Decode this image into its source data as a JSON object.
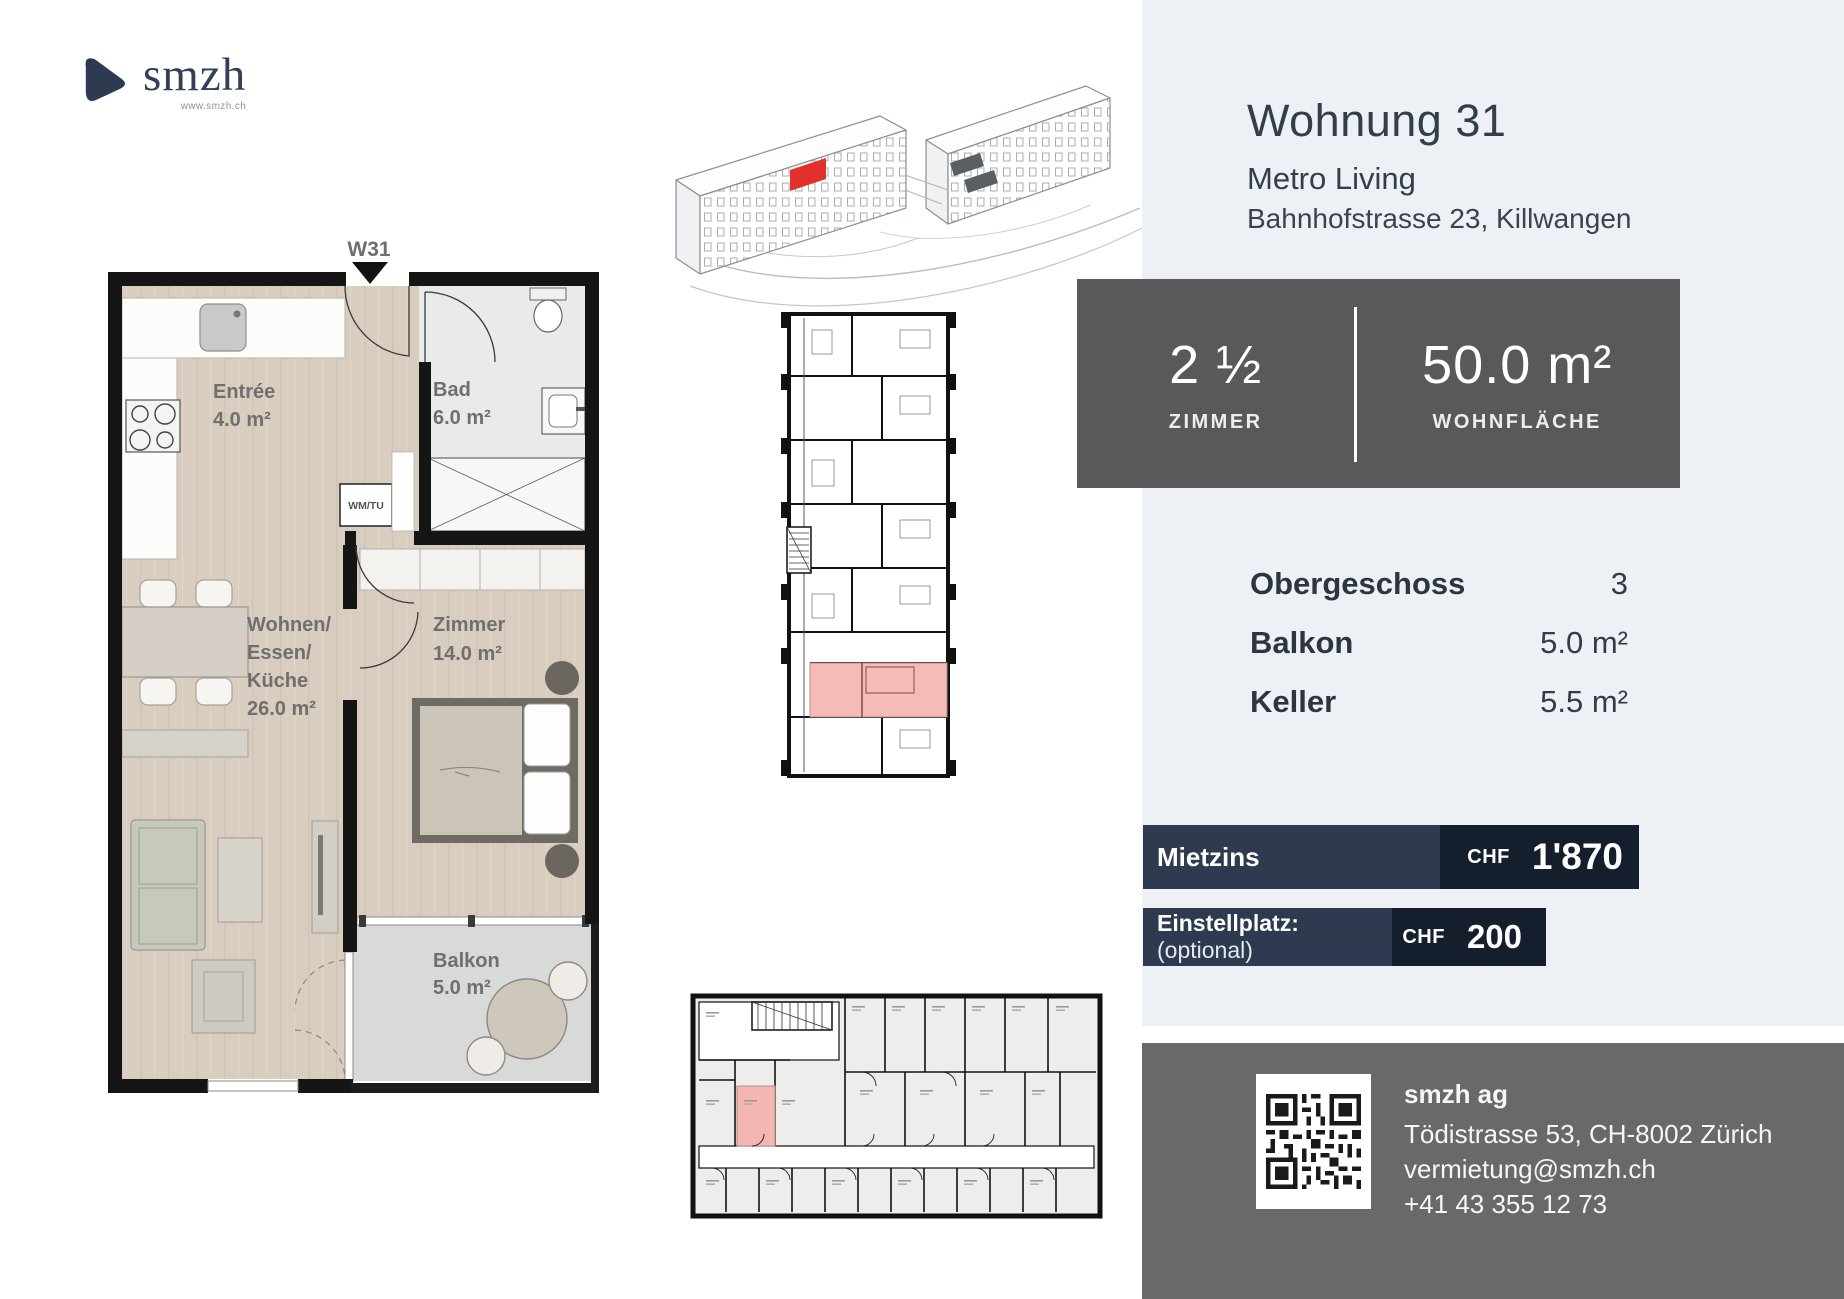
{
  "brand": {
    "name": "smzh",
    "website": "www.smzh.ch"
  },
  "header": {
    "title": "Wohnung 31",
    "project": "Metro Living",
    "address": "Bahnhofstrasse 23, Killwangen"
  },
  "stats": {
    "rooms": {
      "value": "2 ½",
      "label": "ZIMMER"
    },
    "area": {
      "value": "50.0 m²",
      "label": "WOHNFLÄCHE"
    }
  },
  "details": {
    "rows": [
      {
        "label": "Obergeschoss",
        "value": "3"
      },
      {
        "label": "Balkon",
        "value": "5.0 m²"
      },
      {
        "label": "Keller",
        "value": "5.5 m²"
      }
    ]
  },
  "pricing": {
    "rent": {
      "label": "Mietzins",
      "currency": "CHF",
      "value": "1'870"
    },
    "parking": {
      "label": "Einstellplatz:",
      "suffix": "(optional)",
      "currency": "CHF",
      "value": "200"
    }
  },
  "contact": {
    "company": "smzh ag",
    "address": "Tödistrasse 53, CH-8002 Zürich",
    "email": "vermietung@smzh.ch",
    "phone": "+41 43 355 12 73"
  },
  "floorplan": {
    "unit": "W31",
    "entree": {
      "name": "Entrée",
      "area": "4.0 m²"
    },
    "bad": {
      "name": "Bad",
      "area": "6.0 m²"
    },
    "wm": "WM/TU",
    "living": {
      "line1": "Wohnen/",
      "line2": "Essen/",
      "line3": "Küche",
      "area": "26.0 m²"
    },
    "zimmer": {
      "name": "Zimmer",
      "area": "14.0 m²"
    },
    "balkon": {
      "name": "Balkon",
      "area": "5.0 m²"
    }
  },
  "colors": {
    "panel": "#edf1f6",
    "stats_box": "#59595b",
    "footer": "#69696b",
    "navy": "#2d3a50",
    "navy_dark": "#141e2c",
    "unit_highlight_red": "#e0312a",
    "unit_highlight_pink": "#f5bcb7"
  }
}
